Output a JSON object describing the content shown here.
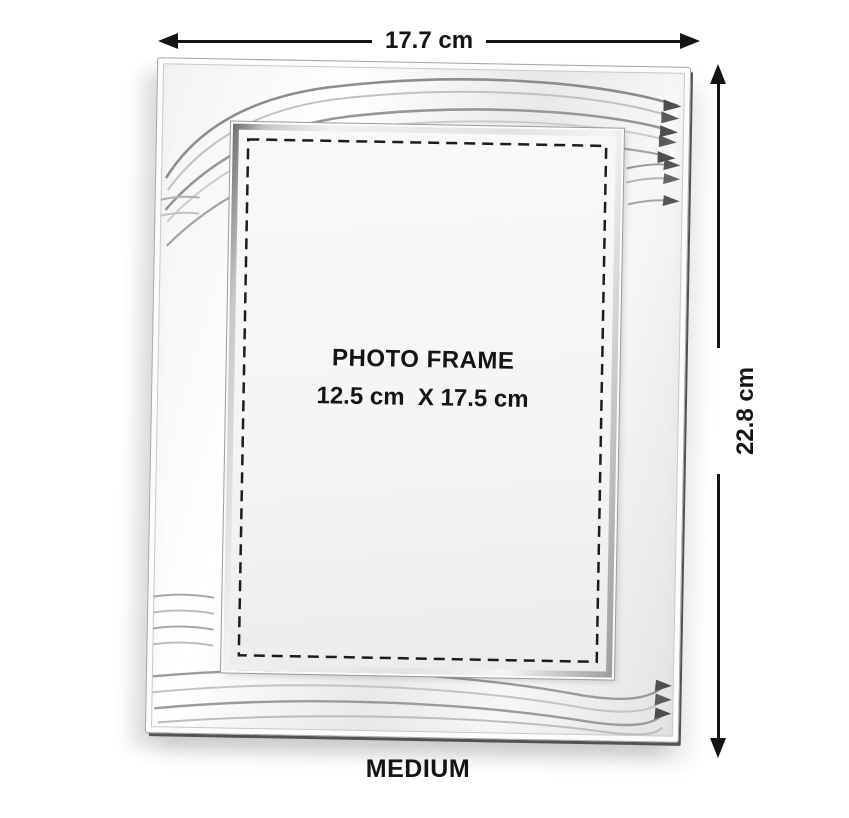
{
  "annotations": {
    "width_label": "17.7 cm",
    "height_label": "22.8 cm"
  },
  "frame_placeholder": {
    "title": "PHOTO FRAME",
    "size_text": "12.5 cm  X 17.5 cm"
  },
  "size_label": "MEDIUM",
  "colors": {
    "annotation": "#141414",
    "dash": "#1c1c1c",
    "photo_bg": "#f4f4f4",
    "page_bg": "#ffffff"
  }
}
